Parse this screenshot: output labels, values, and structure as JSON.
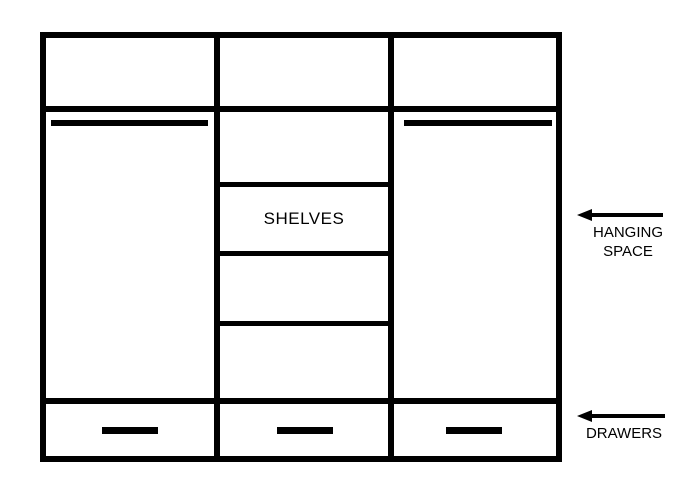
{
  "figure": {
    "description": "wardrobe interior layout diagram",
    "background_color": "#ffffff",
    "line_color": "#000000"
  },
  "wardrobe": {
    "columns": 3,
    "top_compartments": 3,
    "hanging_rails": 2,
    "middle_shelf_lines": 3,
    "drawers": 3,
    "shelves_label": "SHELVES"
  },
  "annotations": {
    "hanging": {
      "line1": "HANGING",
      "line2": "SPACE",
      "arrow_direction": "left"
    },
    "drawers": {
      "label": "DRAWERS",
      "arrow_direction": "left"
    }
  }
}
